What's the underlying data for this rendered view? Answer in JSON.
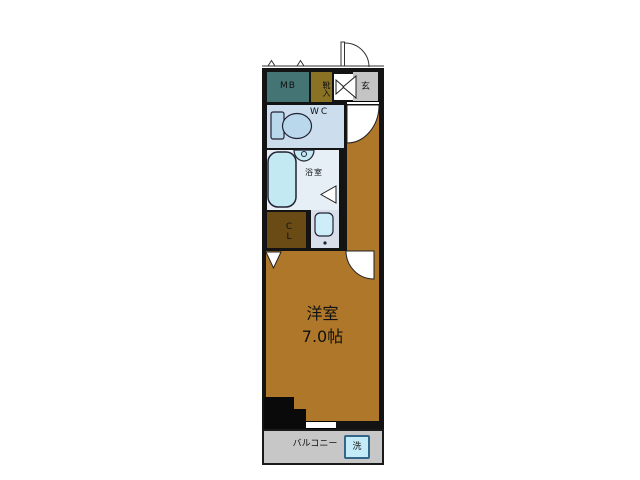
{
  "floorplan": {
    "meter_box_label": "MB",
    "shoe_storage_label": "靴入",
    "entrance_label": "玄",
    "wc_label": "WC",
    "bathroom_label": "浴室",
    "closet_label": "CL",
    "main_room_label": "洋室",
    "main_room_size": "7.0帖",
    "balcony_label": "バルコニー",
    "washer_label": "洗",
    "colors": {
      "wall": "#131313",
      "meter_box": "#457474",
      "shoe_storage": "#8a7224",
      "entrance": "#c4c4c4",
      "wc_room": "#ccddee",
      "bathroom": "#e6eef6",
      "bathtub": "#c3e9f3",
      "closet": "#6a4a15",
      "washroom": "#d8deea",
      "room_floor": "#ae7729",
      "balcony": "#c7c7c7",
      "washer": "#c3ecf8",
      "washer_border": "#336688"
    }
  }
}
